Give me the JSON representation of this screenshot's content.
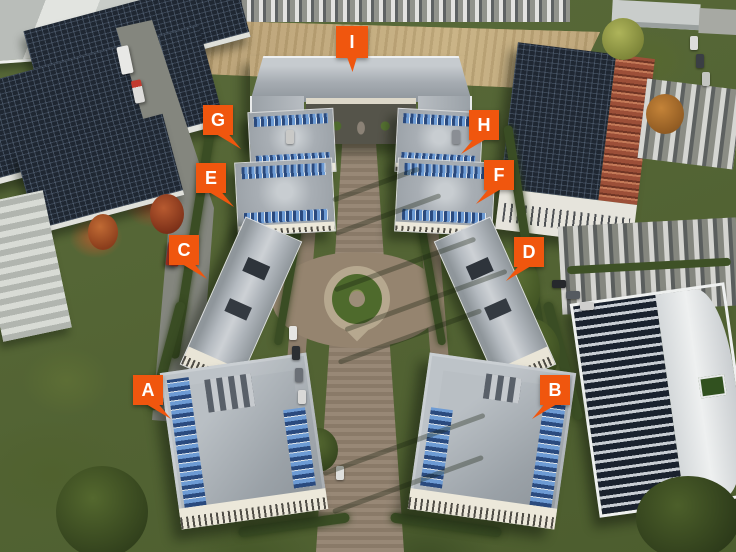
{
  "image": {
    "kind": "aerial-photo-with-building-markers"
  },
  "colors": {
    "marker_background": "#F0560E",
    "marker_text": "#FFFFFF"
  },
  "markers": [
    {
      "label": "A"
    },
    {
      "label": "B"
    },
    {
      "label": "C"
    },
    {
      "label": "D"
    },
    {
      "label": "E"
    },
    {
      "label": "F"
    },
    {
      "label": "G"
    },
    {
      "label": "H"
    },
    {
      "label": "I"
    }
  ]
}
